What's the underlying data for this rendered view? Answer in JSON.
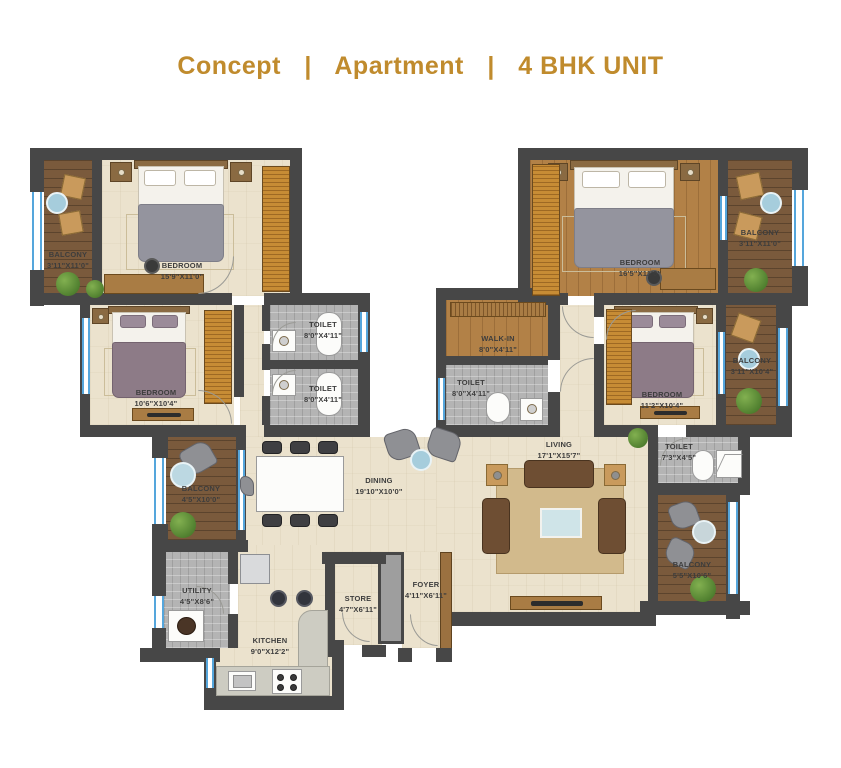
{
  "title": {
    "part1": "Concept",
    "sep": "|",
    "part2": "Apartment",
    "part3": "4 BHK UNIT"
  },
  "colors": {
    "title_gold": "#c08b2d",
    "wall": "#474747",
    "floor_tile": "#ebe2cd",
    "floor_wood": "#b28147",
    "floor_deck": "#7a5a3c",
    "floor_gray_tile": "#b4b4b4",
    "window_blue": "#55a6dc",
    "wardrobe_wood": "#c78c35",
    "sofa_brown": "#6e4e33",
    "bed_purple": "#8d7b87",
    "plant_green": "#4c7c2c"
  },
  "rooms": {
    "balcony_top_left": {
      "name": "BALCONY",
      "dims": "3'11\"X11'0\""
    },
    "bedroom_1": {
      "name": "BEDROOM",
      "dims": "15'9\"X11'0\""
    },
    "bedroom_2": {
      "name": "BEDROOM",
      "dims": "10'6\"X10'4\""
    },
    "toilet_1": {
      "name": "TOILET",
      "dims": "8'0\"X4'11\""
    },
    "toilet_2": {
      "name": "TOILET",
      "dims": "8'0\"X4'11\""
    },
    "walk_in": {
      "name": "WALK-IN",
      "dims": "8'0\"X4'11\""
    },
    "toilet_3": {
      "name": "TOILET",
      "dims": "8'0\"X4'11\""
    },
    "bedroom_master": {
      "name": "BEDROOM",
      "dims": "16'5\"X11'0\""
    },
    "balcony_top_right": {
      "name": "BALCONY",
      "dims": "3'11\"X11'0\""
    },
    "bedroom_4": {
      "name": "BEDROOM",
      "dims": "11'2\"X10'4\""
    },
    "balcony_mid_right": {
      "name": "BALCONY",
      "dims": "3'11\"X10'4\""
    },
    "balcony_mid_left": {
      "name": "BALCONY",
      "dims": "4'5\"X10'0\""
    },
    "dining": {
      "name": "DINING",
      "dims": "19'10\"X10'0\""
    },
    "living": {
      "name": "LIVING",
      "dims": "17'1\"X15'7\""
    },
    "toilet_4": {
      "name": "TOILET",
      "dims": "7'3\"X4'5\""
    },
    "balcony_bottom_right": {
      "name": "BALCONY",
      "dims": "5'5\"X10'6\""
    },
    "utility": {
      "name": "UTILITY",
      "dims": "4'5\"X8'6\""
    },
    "kitchen": {
      "name": "KITCHEN",
      "dims": "9'0\"X12'2\""
    },
    "store": {
      "name": "STORE",
      "dims": "4'7\"X6'11\""
    },
    "foyer": {
      "name": "FOYER",
      "dims": "4'11\"X6'11\""
    }
  }
}
